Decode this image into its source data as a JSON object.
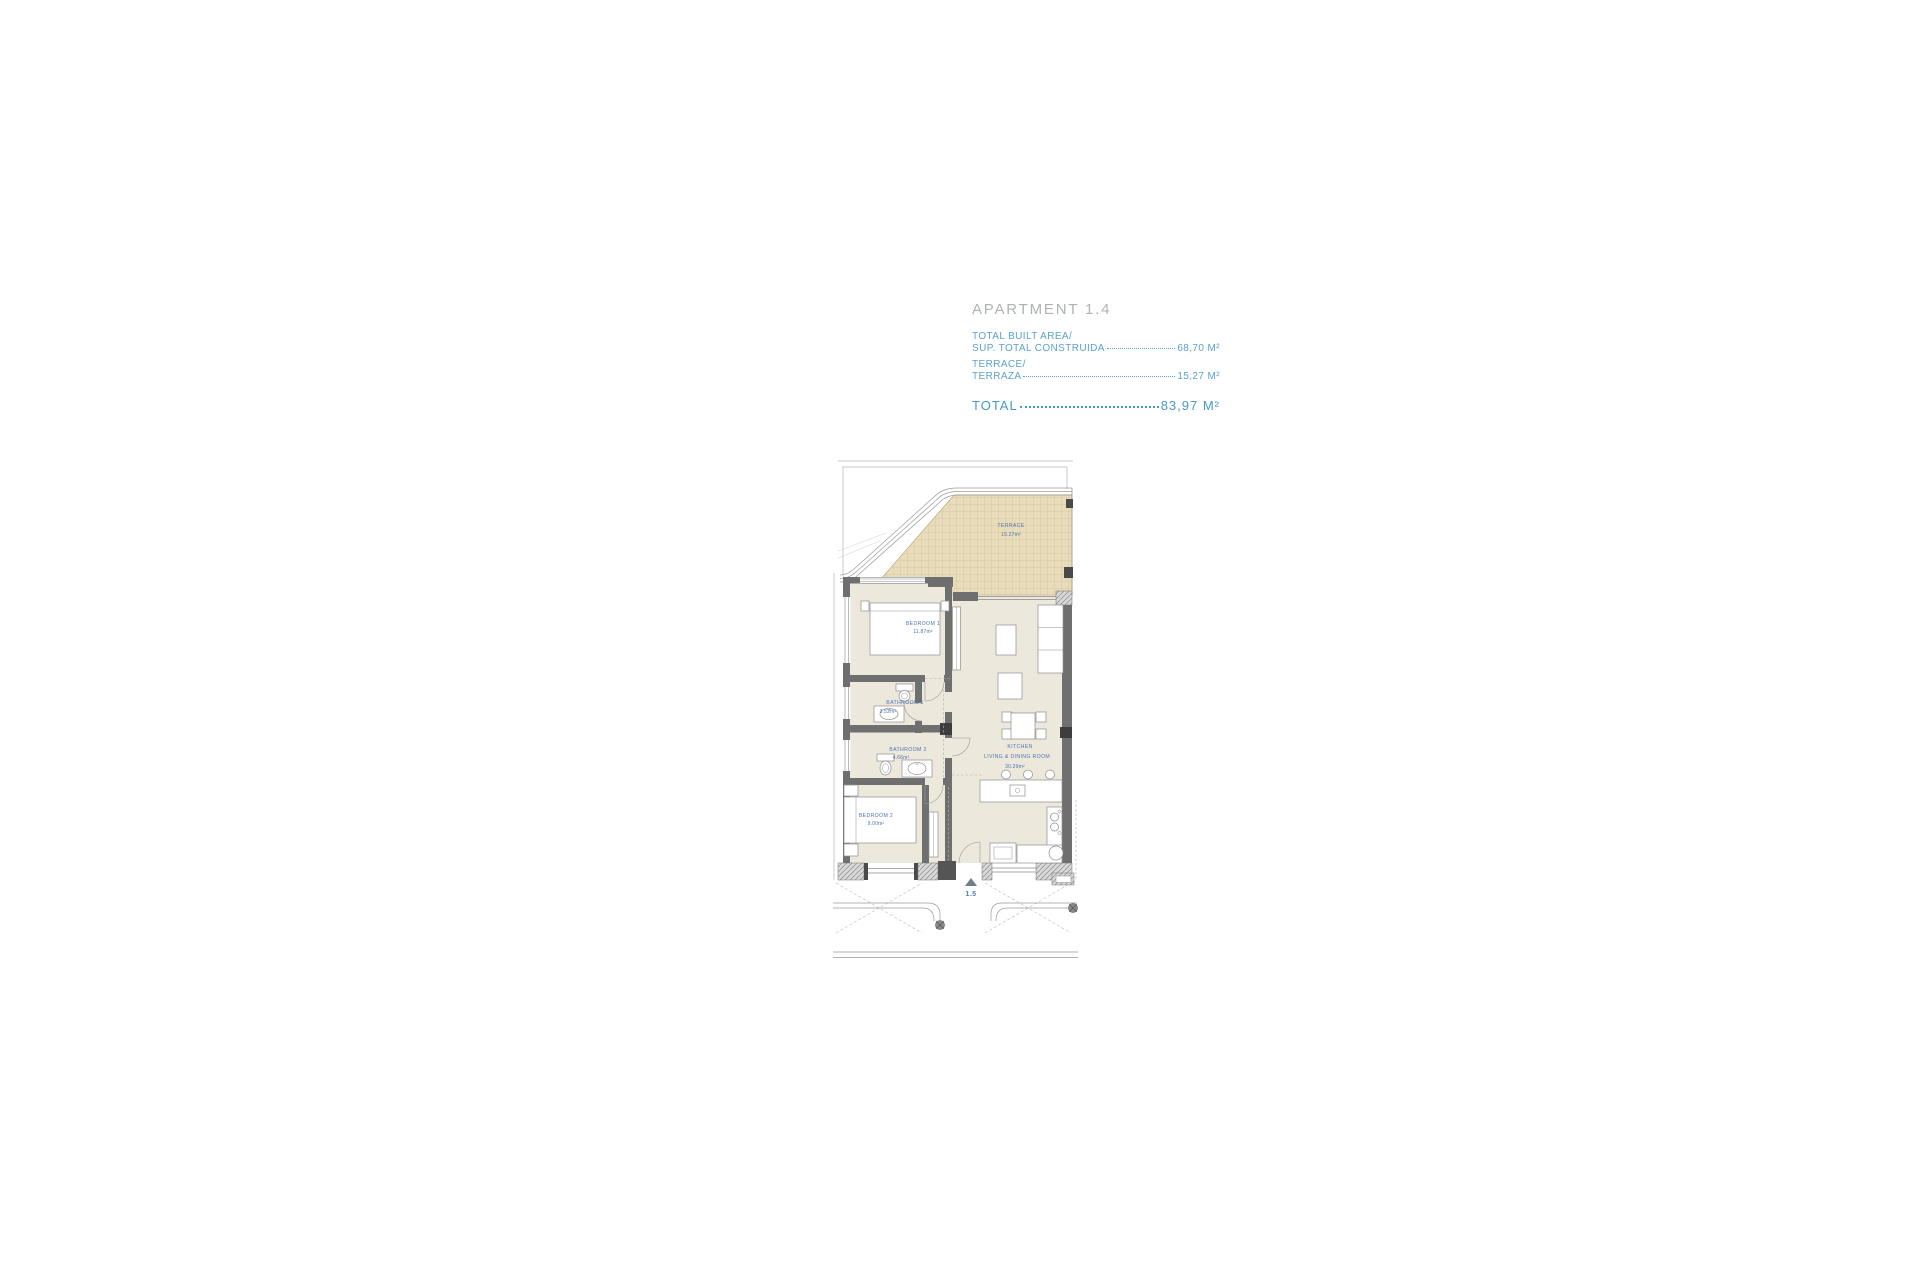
{
  "header": {
    "title": "APARTMENT 1.4",
    "area_rows": [
      {
        "line1": "TOTAL BUILT AREA/",
        "line2": "SUP. TOTAL CONSTRUIDA",
        "value": "68,70 M²"
      },
      {
        "line1": "TERRACE/",
        "line2": "TERRAZA",
        "value": "15,27 M²"
      }
    ],
    "total": {
      "label": "TOTAL",
      "value": "83,97 M²"
    }
  },
  "plan": {
    "rooms": {
      "terrace": {
        "name": "TERRACE",
        "area": "15.27m²"
      },
      "bedroom1": {
        "name": "BEDROOM 1",
        "area": "11.87m²"
      },
      "bathroom1": {
        "name": "BATHROOM 1",
        "area": "3.52m²"
      },
      "bathroom2": {
        "name": "BATHROOM 2",
        "area": "4.66m²"
      },
      "bedroom2": {
        "name": "BEDROOM 2",
        "area": "9.00m²"
      },
      "kitchen": {
        "name": "KITCHEN",
        "name2": "LIVING & DINING ROOM",
        "area": "30.29m²"
      }
    },
    "entry_marker": "1.5"
  },
  "colors": {
    "title_gray": "#aeb2b5",
    "header_blue": "#5ba2c9",
    "total_blue": "#4599c7",
    "label_blue": "#4f74b2",
    "terrace_tan": "#e9dcba",
    "terrace_grid": "#c9b68c",
    "floor_beige": "#ede8dc",
    "wall_gray": "#6f6f6f",
    "hatch_gray": "#8a8a8a"
  }
}
